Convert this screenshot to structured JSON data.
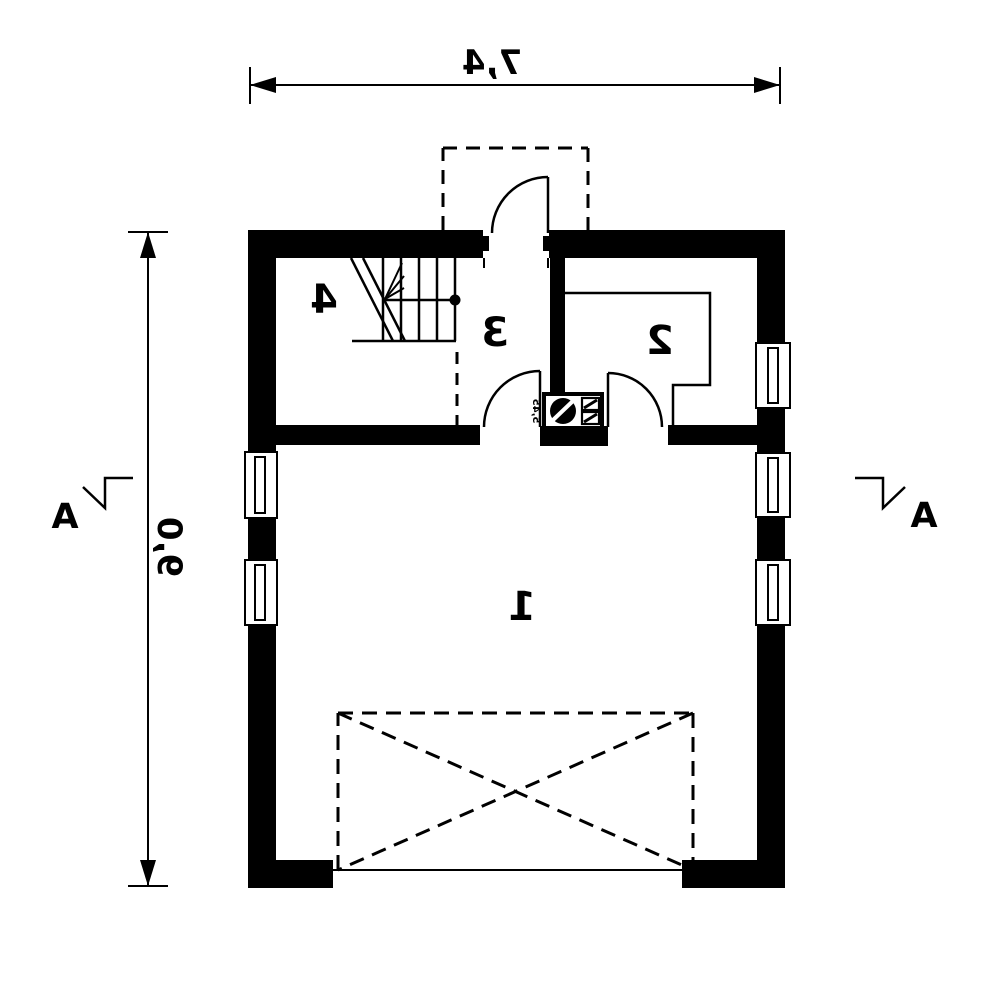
{
  "page": {
    "title": "Mirrored architectural floor plan, ground storey"
  },
  "colors": {
    "line": "#000000",
    "background": "#ffffff"
  },
  "dimensions": {
    "top": "7,4",
    "left": "9,0"
  },
  "section": {
    "left": "A",
    "right": "A"
  },
  "rooms": [
    {
      "label": "1"
    },
    {
      "label": "2"
    },
    {
      "label": "3"
    },
    {
      "label": "4"
    }
  ],
  "stove": {
    "micro_label": "5,45"
  },
  "symbols": {
    "stove": "stove-icon",
    "door_swing": "door-swing-arc",
    "window": "window-symbol",
    "stairs": "stairs-symbol",
    "newel": "newel-post-dot",
    "terrace": "terrace-dashed-outline",
    "porch": "porch-dashed-outline",
    "section_cut": "section-cut-mark",
    "dimension_arrow": "dimension-arrow"
  }
}
